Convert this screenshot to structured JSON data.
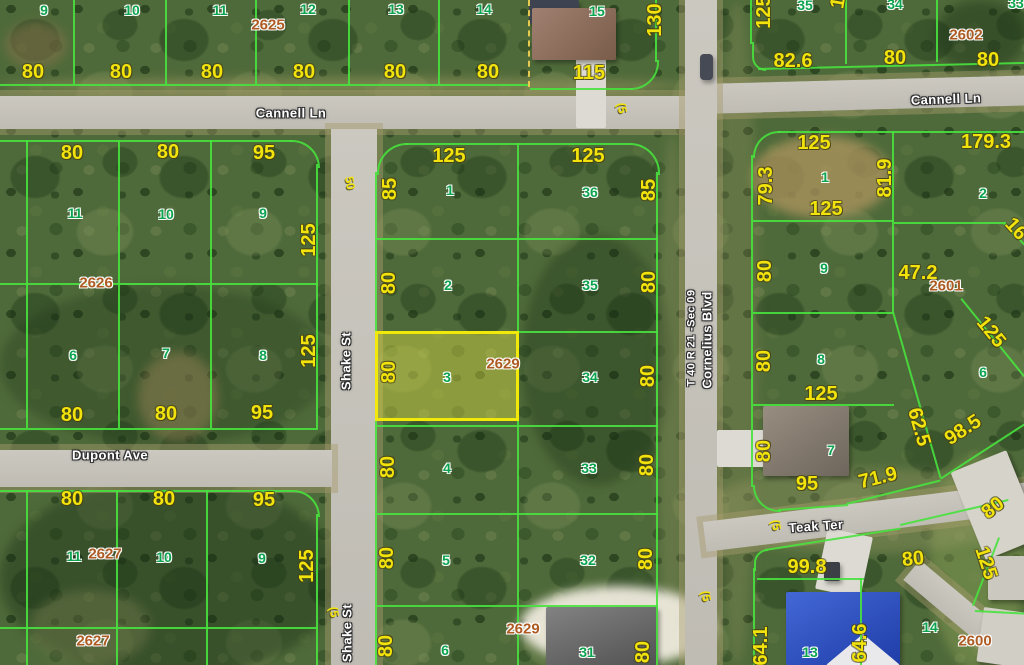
{
  "colors": {
    "parcel_line_green": "rgba(72,226,62,0.9)",
    "lot_number_green": "#0ca34f",
    "dimension_yellow": "#f2e30c",
    "block_number_orange": "#ad5b22",
    "street_label_white": "#ffffff",
    "highlight_border_yellow": "#f0e90a",
    "highlight_fill_yellow": "rgba(226,224,70,0.42)",
    "road_gray": "#cbc8c0",
    "dashed_boundary_yellow": "#e6c94f"
  },
  "map": {
    "highlighted_parcel": {
      "lot": "3",
      "block": "2629",
      "frontage": "80"
    },
    "street_labels": [
      {
        "text": "Cannell Ln",
        "x": 291,
        "y": 113,
        "rot": 0
      },
      {
        "text": "Cannell Ln",
        "x": 946,
        "y": 99,
        "rot": -2
      },
      {
        "text": "Shake St",
        "x": 346,
        "y": 361,
        "rot": -90
      },
      {
        "text": "Shake St",
        "x": 347,
        "y": 633,
        "rot": -90
      },
      {
        "text": "Dupont Ave",
        "x": 110,
        "y": 455,
        "rot": 0
      },
      {
        "text": "Cornelius Blvd",
        "x": 707,
        "y": 340,
        "rot": -90
      },
      {
        "text": "T 40 R 21 -Sec 09",
        "x": 692,
        "y": 338,
        "rot": -90
      },
      {
        "text": "Teak Ter",
        "x": 816,
        "y": 526,
        "rot": -4
      }
    ],
    "lot_labels": [
      {
        "text": "9",
        "x": 44,
        "y": 10
      },
      {
        "text": "10",
        "x": 132,
        "y": 10
      },
      {
        "text": "11",
        "x": 220,
        "y": 10
      },
      {
        "text": "12",
        "x": 308,
        "y": 9
      },
      {
        "text": "13",
        "x": 396,
        "y": 9
      },
      {
        "text": "14",
        "x": 484,
        "y": 9
      },
      {
        "text": "15",
        "x": 597,
        "y": 11
      },
      {
        "text": "35",
        "x": 805,
        "y": 5
      },
      {
        "text": "34",
        "x": 895,
        "y": 4
      },
      {
        "text": "33",
        "x": 1016,
        "y": 3
      },
      {
        "text": "11",
        "x": 75,
        "y": 213
      },
      {
        "text": "10",
        "x": 166,
        "y": 214
      },
      {
        "text": "9",
        "x": 263,
        "y": 213
      },
      {
        "text": "6",
        "x": 73,
        "y": 355
      },
      {
        "text": "7",
        "x": 166,
        "y": 353
      },
      {
        "text": "8",
        "x": 263,
        "y": 355
      },
      {
        "text": "11",
        "x": 74,
        "y": 556
      },
      {
        "text": "10",
        "x": 164,
        "y": 557
      },
      {
        "text": "9",
        "x": 262,
        "y": 558
      },
      {
        "text": "1",
        "x": 450,
        "y": 190
      },
      {
        "text": "36",
        "x": 590,
        "y": 192
      },
      {
        "text": "2",
        "x": 448,
        "y": 285
      },
      {
        "text": "35",
        "x": 590,
        "y": 285
      },
      {
        "text": "3",
        "x": 447,
        "y": 377
      },
      {
        "text": "34",
        "x": 590,
        "y": 377
      },
      {
        "text": "4",
        "x": 447,
        "y": 468
      },
      {
        "text": "33",
        "x": 589,
        "y": 468
      },
      {
        "text": "5",
        "x": 446,
        "y": 560
      },
      {
        "text": "32",
        "x": 588,
        "y": 560
      },
      {
        "text": "6",
        "x": 445,
        "y": 650
      },
      {
        "text": "31",
        "x": 587,
        "y": 652
      },
      {
        "text": "1",
        "x": 825,
        "y": 177
      },
      {
        "text": "2",
        "x": 983,
        "y": 193
      },
      {
        "text": "9",
        "x": 824,
        "y": 268
      },
      {
        "text": "6",
        "x": 983,
        "y": 372
      },
      {
        "text": "8",
        "x": 821,
        "y": 359
      },
      {
        "text": "7",
        "x": 831,
        "y": 450
      },
      {
        "text": "13",
        "x": 810,
        "y": 652
      },
      {
        "text": "14",
        "x": 930,
        "y": 627
      }
    ],
    "dimension_labels": [
      {
        "text": "80",
        "x": 33,
        "y": 72,
        "rot": 0
      },
      {
        "text": "80",
        "x": 121,
        "y": 72,
        "rot": 0
      },
      {
        "text": "80",
        "x": 212,
        "y": 72,
        "rot": 0
      },
      {
        "text": "80",
        "x": 304,
        "y": 72,
        "rot": 0
      },
      {
        "text": "80",
        "x": 395,
        "y": 72,
        "rot": 0
      },
      {
        "text": "80",
        "x": 488,
        "y": 72,
        "rot": 0
      },
      {
        "text": "115",
        "x": 589,
        "y": 73,
        "rot": 0
      },
      {
        "text": "130",
        "x": 655,
        "y": 20,
        "rot": -90
      },
      {
        "text": "125",
        "x": 764,
        "y": 12,
        "rot": -90
      },
      {
        "text": "82.6",
        "x": 793,
        "y": 61,
        "rot": 0
      },
      {
        "text": "80",
        "x": 895,
        "y": 58,
        "rot": 0
      },
      {
        "text": "80",
        "x": 988,
        "y": 60,
        "rot": 0
      },
      {
        "text": "125",
        "x": 840,
        "y": -8,
        "rot": -80
      },
      {
        "text": "80",
        "x": 72,
        "y": 153,
        "rot": 0
      },
      {
        "text": "80",
        "x": 168,
        "y": 152,
        "rot": 0
      },
      {
        "text": "95",
        "x": 264,
        "y": 153,
        "rot": 0
      },
      {
        "text": "125",
        "x": 309,
        "y": 240,
        "rot": -90
      },
      {
        "text": "80",
        "x": 72,
        "y": 415,
        "rot": 0
      },
      {
        "text": "80",
        "x": 166,
        "y": 414,
        "rot": 0
      },
      {
        "text": "95",
        "x": 262,
        "y": 413,
        "rot": 0
      },
      {
        "text": "125",
        "x": 309,
        "y": 351,
        "rot": -90
      },
      {
        "text": "80",
        "x": 72,
        "y": 499,
        "rot": 0
      },
      {
        "text": "80",
        "x": 164,
        "y": 499,
        "rot": 0
      },
      {
        "text": "95",
        "x": 264,
        "y": 500,
        "rot": 0
      },
      {
        "text": "125",
        "x": 307,
        "y": 566,
        "rot": -90
      },
      {
        "text": "125",
        "x": 449,
        "y": 156,
        "rot": 0
      },
      {
        "text": "125",
        "x": 588,
        "y": 156,
        "rot": 0
      },
      {
        "text": "85",
        "x": 390,
        "y": 189,
        "rot": -90
      },
      {
        "text": "85",
        "x": 649,
        "y": 190,
        "rot": -90
      },
      {
        "text": "80",
        "x": 389,
        "y": 283,
        "rot": -90
      },
      {
        "text": "80",
        "x": 649,
        "y": 282,
        "rot": -90
      },
      {
        "text": "80",
        "x": 389,
        "y": 372,
        "rot": -90
      },
      {
        "text": "80",
        "x": 648,
        "y": 376,
        "rot": -90
      },
      {
        "text": "80",
        "x": 388,
        "y": 467,
        "rot": -90
      },
      {
        "text": "80",
        "x": 647,
        "y": 465,
        "rot": -90
      },
      {
        "text": "80",
        "x": 387,
        "y": 558,
        "rot": -90
      },
      {
        "text": "80",
        "x": 646,
        "y": 559,
        "rot": -90
      },
      {
        "text": "80",
        "x": 386,
        "y": 646,
        "rot": -90
      },
      {
        "text": "80",
        "x": 643,
        "y": 652,
        "rot": -90
      },
      {
        "text": "125",
        "x": 814,
        "y": 143,
        "rot": 0
      },
      {
        "text": "79.3",
        "x": 766,
        "y": 186,
        "rot": -90
      },
      {
        "text": "81.9",
        "x": 885,
        "y": 178,
        "rot": -90
      },
      {
        "text": "125",
        "x": 826,
        "y": 209,
        "rot": 0
      },
      {
        "text": "179.3",
        "x": 986,
        "y": 142,
        "rot": 0
      },
      {
        "text": "16",
        "x": 1016,
        "y": 229,
        "rot": 48
      },
      {
        "text": "80",
        "x": 765,
        "y": 271,
        "rot": -90
      },
      {
        "text": "47.2",
        "x": 918,
        "y": 273,
        "rot": 0
      },
      {
        "text": "125",
        "x": 991,
        "y": 332,
        "rot": 51
      },
      {
        "text": "80",
        "x": 764,
        "y": 361,
        "rot": -90
      },
      {
        "text": "125",
        "x": 821,
        "y": 394,
        "rot": 0
      },
      {
        "text": "62.5",
        "x": 919,
        "y": 427,
        "rot": 74
      },
      {
        "text": "98.5",
        "x": 963,
        "y": 430,
        "rot": -33
      },
      {
        "text": "80",
        "x": 764,
        "y": 451,
        "rot": -90
      },
      {
        "text": "95",
        "x": 807,
        "y": 484,
        "rot": 0
      },
      {
        "text": "71.9",
        "x": 878,
        "y": 478,
        "rot": -14
      },
      {
        "text": "99.8",
        "x": 807,
        "y": 567,
        "rot": 0
      },
      {
        "text": "80",
        "x": 913,
        "y": 559,
        "rot": -6
      },
      {
        "text": "80",
        "x": 993,
        "y": 508,
        "rot": -38
      },
      {
        "text": "125",
        "x": 986,
        "y": 563,
        "rot": 72
      },
      {
        "text": "64.1",
        "x": 761,
        "y": 646,
        "rot": -90
      },
      {
        "text": "64.6",
        "x": 860,
        "y": 643,
        "rot": -90
      }
    ],
    "block_labels": [
      {
        "text": "2625",
        "x": 268,
        "y": 25
      },
      {
        "text": "2626",
        "x": 96,
        "y": 283
      },
      {
        "text": "2627",
        "x": 105,
        "y": 554
      },
      {
        "text": "2627",
        "x": 93,
        "y": 641
      },
      {
        "text": "2629",
        "x": 503,
        "y": 364
      },
      {
        "text": "2629",
        "x": 523,
        "y": 629
      },
      {
        "text": "2601",
        "x": 946,
        "y": 286
      },
      {
        "text": "2602",
        "x": 966,
        "y": 35
      },
      {
        "text": "2600",
        "x": 975,
        "y": 641
      }
    ],
    "curve_labels": [
      {
        "text": "50",
        "x": 350,
        "y": 183,
        "rot": 80
      },
      {
        "text": "(5",
        "x": 622,
        "y": 108,
        "rot": 80
      },
      {
        "text": "(5",
        "x": 334,
        "y": 612,
        "rot": 80
      },
      {
        "text": "(5",
        "x": 776,
        "y": 525,
        "rot": 80
      },
      {
        "text": "(5",
        "x": 706,
        "y": 596,
        "rot": 80
      }
    ]
  }
}
